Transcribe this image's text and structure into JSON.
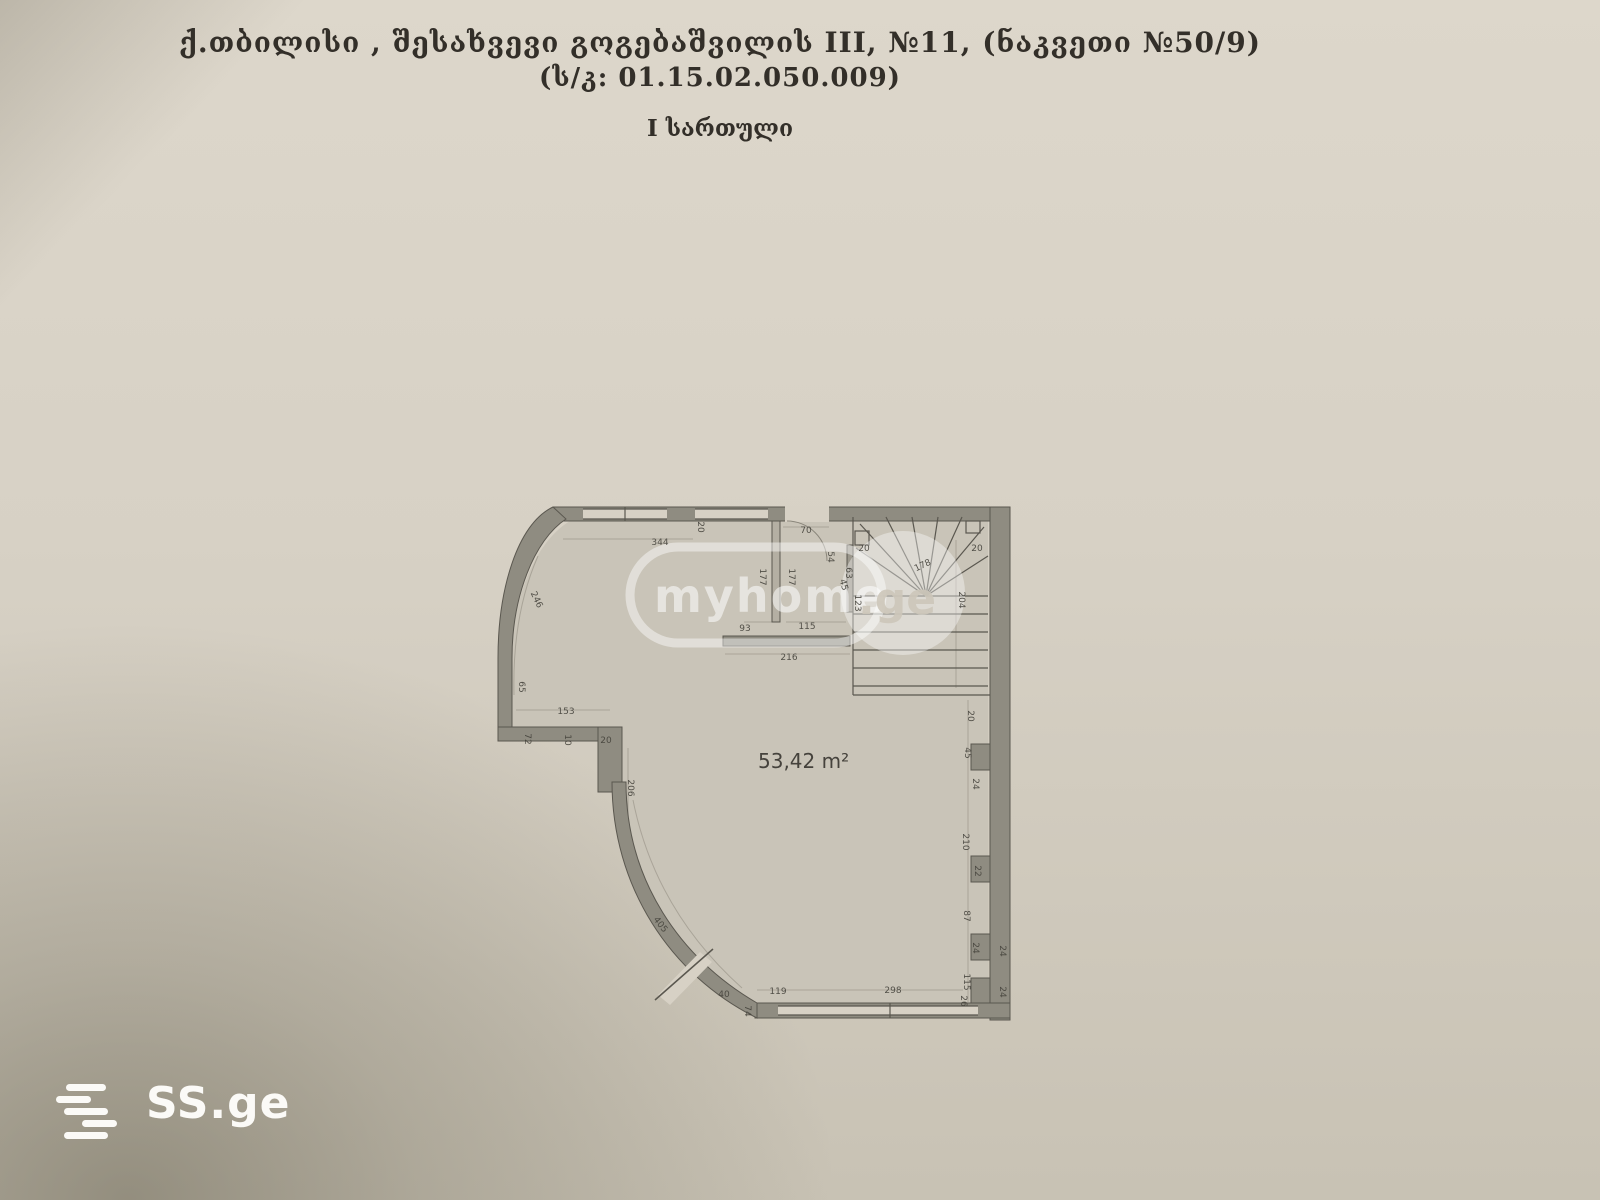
{
  "document": {
    "title_line1": "ქ.თბილისი , შესახვევი გოგებაშვილის III, №11, (ნაკვეთი №50/9)",
    "title_line2": "(ს/კ: 01.15.02.050.009)",
    "title_line3": "I სართული"
  },
  "plan": {
    "area_label": "53,42 m²",
    "dimensions": [
      {
        "t": "344",
        "x": 660,
        "y": 543,
        "r": 0
      },
      {
        "t": "20",
        "x": 700,
        "y": 527,
        "r": 90
      },
      {
        "t": "70",
        "x": 806,
        "y": 531,
        "r": 0
      },
      {
        "t": "54",
        "x": 830,
        "y": 557,
        "r": 90
      },
      {
        "t": "177",
        "x": 762,
        "y": 577,
        "r": 90
      },
      {
        "t": "177",
        "x": 791,
        "y": 577,
        "r": 90
      },
      {
        "t": "45",
        "x": 843,
        "y": 585,
        "r": 75
      },
      {
        "t": "20",
        "x": 864,
        "y": 549,
        "r": 0
      },
      {
        "t": "178",
        "x": 923,
        "y": 566,
        "r": -25
      },
      {
        "t": "20",
        "x": 977,
        "y": 549,
        "r": 0
      },
      {
        "t": "63",
        "x": 848,
        "y": 573,
        "r": 90
      },
      {
        "t": "123",
        "x": 857,
        "y": 603,
        "r": 90
      },
      {
        "t": "204",
        "x": 961,
        "y": 600,
        "r": 90
      },
      {
        "t": "93",
        "x": 745,
        "y": 629,
        "r": 0
      },
      {
        "t": "115",
        "x": 807,
        "y": 627,
        "r": 0
      },
      {
        "t": "216",
        "x": 789,
        "y": 658,
        "r": 0
      },
      {
        "t": "246",
        "x": 536,
        "y": 600,
        "r": 65
      },
      {
        "t": "65",
        "x": 521,
        "y": 687,
        "r": 90
      },
      {
        "t": "153",
        "x": 566,
        "y": 712,
        "r": 0
      },
      {
        "t": "72",
        "x": 527,
        "y": 739,
        "r": 90
      },
      {
        "t": "10",
        "x": 567,
        "y": 740,
        "r": 90
      },
      {
        "t": "20",
        "x": 606,
        "y": 741,
        "r": 0
      },
      {
        "t": "206",
        "x": 630,
        "y": 788,
        "r": 90
      },
      {
        "t": "405",
        "x": 660,
        "y": 925,
        "r": 52
      },
      {
        "t": "40",
        "x": 724,
        "y": 995,
        "r": 0
      },
      {
        "t": "74",
        "x": 747,
        "y": 1011,
        "r": 90
      },
      {
        "t": "119",
        "x": 778,
        "y": 992,
        "r": 0
      },
      {
        "t": "298",
        "x": 893,
        "y": 991,
        "r": 0
      },
      {
        "t": "26",
        "x": 963,
        "y": 1001,
        "r": 90
      },
      {
        "t": "20",
        "x": 970,
        "y": 716,
        "r": 90
      },
      {
        "t": "45",
        "x": 967,
        "y": 753,
        "r": 90
      },
      {
        "t": "24",
        "x": 975,
        "y": 784,
        "r": 90
      },
      {
        "t": "210",
        "x": 965,
        "y": 842,
        "r": 90
      },
      {
        "t": "22",
        "x": 977,
        "y": 871,
        "r": 90
      },
      {
        "t": "87",
        "x": 966,
        "y": 916,
        "r": 90
      },
      {
        "t": "24",
        "x": 975,
        "y": 948,
        "r": 90
      },
      {
        "t": "115",
        "x": 966,
        "y": 982,
        "r": 90
      },
      {
        "t": "24",
        "x": 1002,
        "y": 951,
        "r": 90
      },
      {
        "t": "24",
        "x": 1002,
        "y": 992,
        "r": 90
      }
    ]
  },
  "watermark": {
    "text_main": "myhome",
    "text_suffix": ".ge"
  },
  "logo": {
    "text": "SS.ge"
  },
  "colors": {
    "paper": "#d7d1c5",
    "paperLight": "#ddd7cb",
    "paperDark": "#c8c2b4",
    "floor": "#c9c4b8",
    "wall": "#8f8c81",
    "line": "#5a574f",
    "ink": "#332f29",
    "dimInk": "#45433c",
    "white": "#fbfaf7"
  }
}
